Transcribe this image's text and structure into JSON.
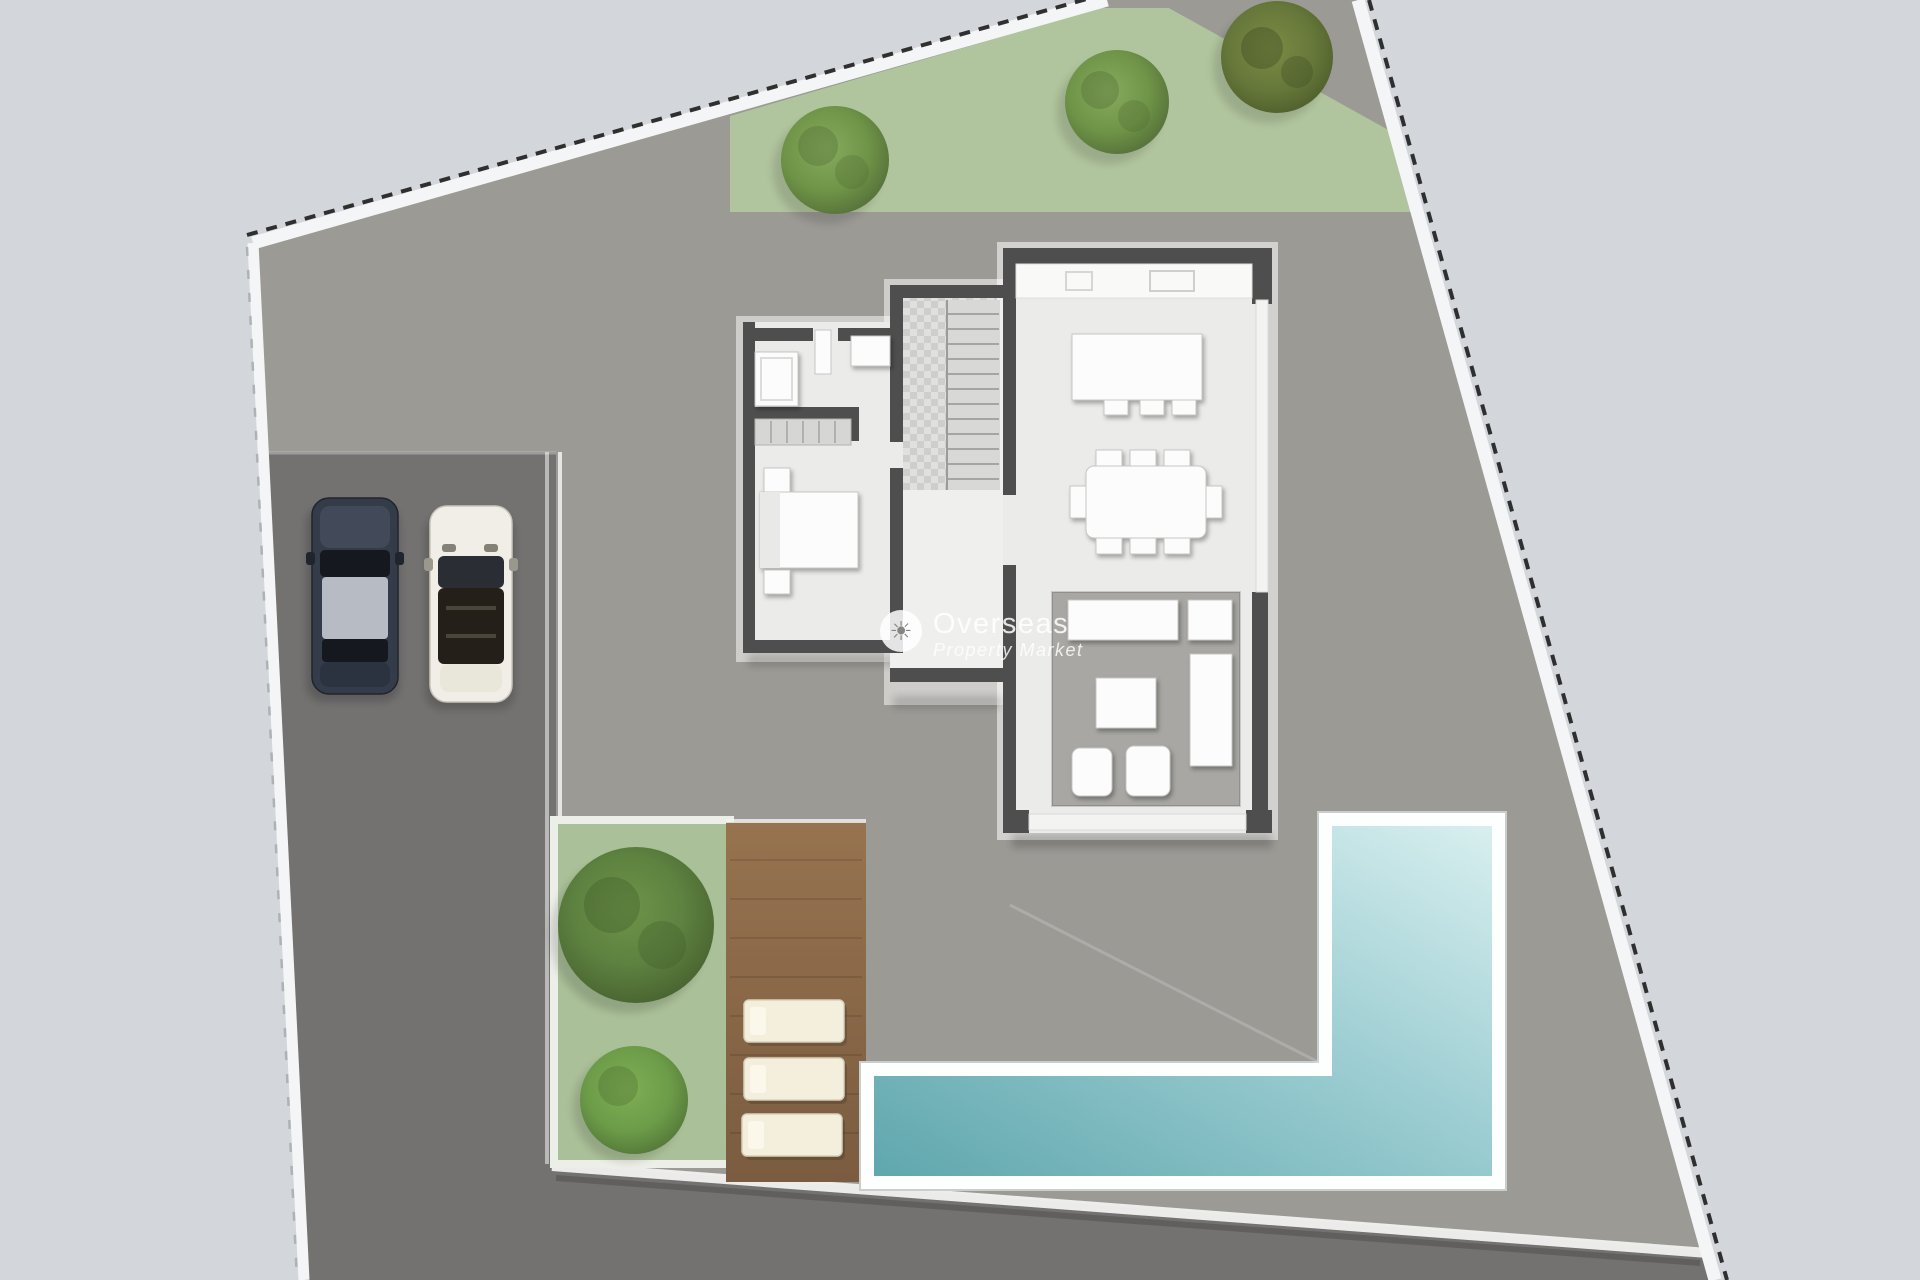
{
  "watermark": {
    "icon": "sun-icon",
    "icon_glyph": "☀",
    "line1": "Overseas",
    "line2": "Property Market"
  },
  "colors": {
    "outside": "#d3d6da",
    "ground": "#9c9a95",
    "paving": "#737271",
    "boundary_white": "#f4f5f6",
    "boundary_dash": "#1d1d1d",
    "boundary_dash_light": "#a9aeb3",
    "trim": "#f2f3f1",
    "grass": "#b0c49d",
    "grass2": "#aac098",
    "tree_light": "#87ab5e",
    "tree_mid": "#6f9447",
    "tree_dark": "#55713a",
    "tree_olive": "#66773a",
    "bush": "#5d8140",
    "bush_light": "#6c9c48",
    "pool_dark": "#5fa7ad",
    "pool_mid": "#9ccdd2",
    "pool_light": "#d8efef",
    "pool_border": "#fdfefe",
    "deck_light": "#97734f",
    "deck_dark": "#7b5c40",
    "lounger": "#f4eedd",
    "lounger_edge": "#d8d0bb",
    "wall": "#4e4e4f",
    "glass_wall": "#f3f3f2",
    "floor": "#ebebea",
    "floor2": "#efefee",
    "sunken": "#a8a7a3",
    "furniture": "#fcfcfc",
    "furniture_edge": "#c6c6c4",
    "counter": "#f9f9f8",
    "stair": "#d8d8d7",
    "tread": "#a5a5a4",
    "wardrobe": "#d6d6d4",
    "car_dark_body": "#353c49",
    "car_dark_hood": "#424a59",
    "car_dark_roof": "#b7bcc4",
    "car_dark_trunk": "#2c3340",
    "car_glass": "#15181e",
    "car_white_body": "#f0eee6",
    "car_white_cabin": "#242019",
    "car_white_rear": "#e9e6da"
  },
  "scene": {
    "type": "villa-site-plan",
    "elements": [
      "plot-boundary",
      "lawn",
      "trees",
      "driveway",
      "car-dark",
      "car-white",
      "house",
      "bedroom",
      "ensuite",
      "wardrobe",
      "staircase",
      "hallway",
      "kitchen",
      "kitchen-island",
      "dining-table",
      "sunken-lounge",
      "garden",
      "bushes",
      "wood-deck",
      "sun-loungers",
      "swimming-pool",
      "terrace"
    ]
  }
}
